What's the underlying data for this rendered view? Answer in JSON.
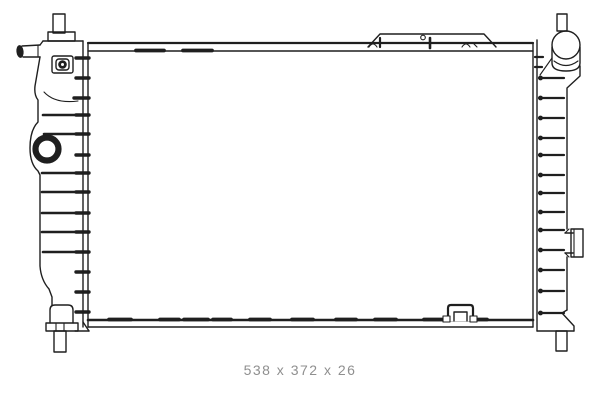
{
  "drawing": {
    "subject": "radiator-technical-line-drawing",
    "dimensions_label": "538 x 372 x 26"
  },
  "colors": {
    "line": "#1f1f1f",
    "dim_text": "#8f8f8f",
    "background": "#ffffff"
  }
}
